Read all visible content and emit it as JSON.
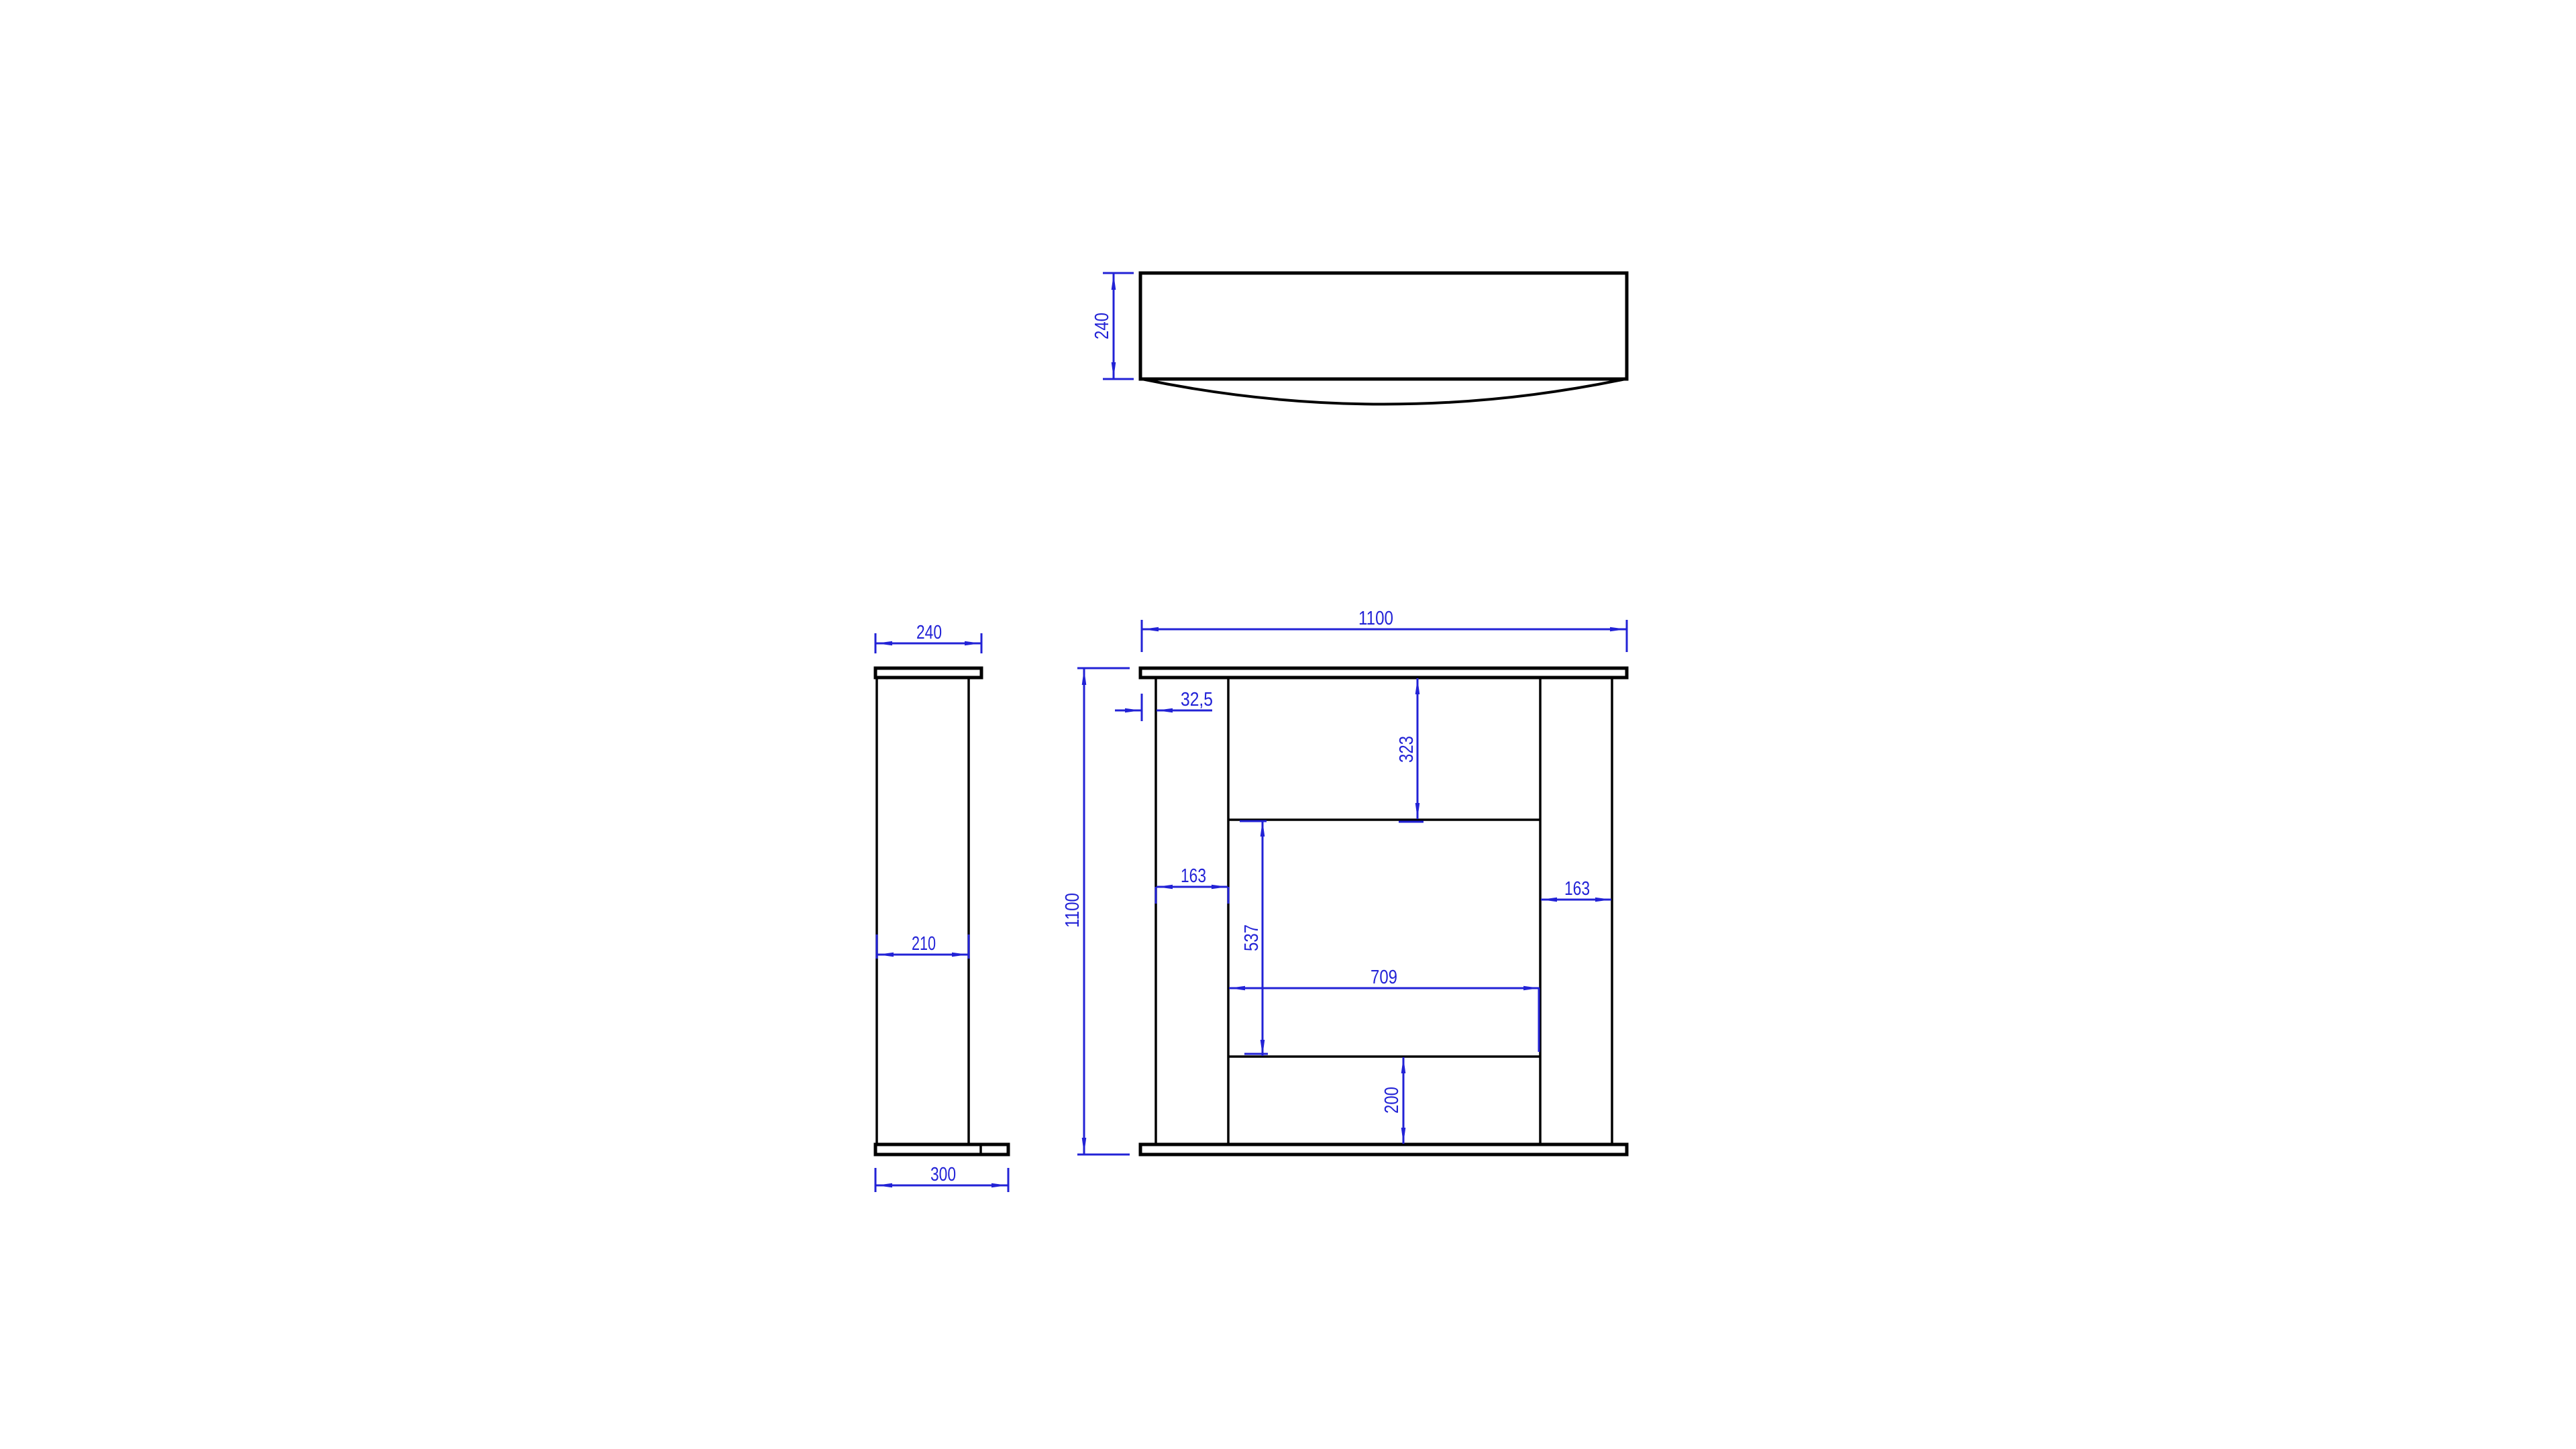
{
  "drawing": {
    "background_color": "#ffffff",
    "geometry_color": "#000000",
    "dimension_color": "#2222d6",
    "views": {
      "top_view": {
        "description": "mantel shelf seen from above with curved front edge",
        "dims": {
          "depth": "240"
        }
      },
      "side_view": {
        "description": "side profile: shelf cap, column, base plinth",
        "dims": {
          "cap_depth": "240",
          "column_depth": "210",
          "base_depth": "300"
        }
      },
      "front_view": {
        "description": "fireplace surround front elevation",
        "dims": {
          "total_width": "1100",
          "total_height": "1100",
          "shelf_overhang": "32,5",
          "upper_recess_height": "323",
          "left_leg_width": "163",
          "right_leg_width": "163",
          "opening_height": "537",
          "opening_width": "709",
          "hearth_height": "200"
        }
      }
    }
  }
}
